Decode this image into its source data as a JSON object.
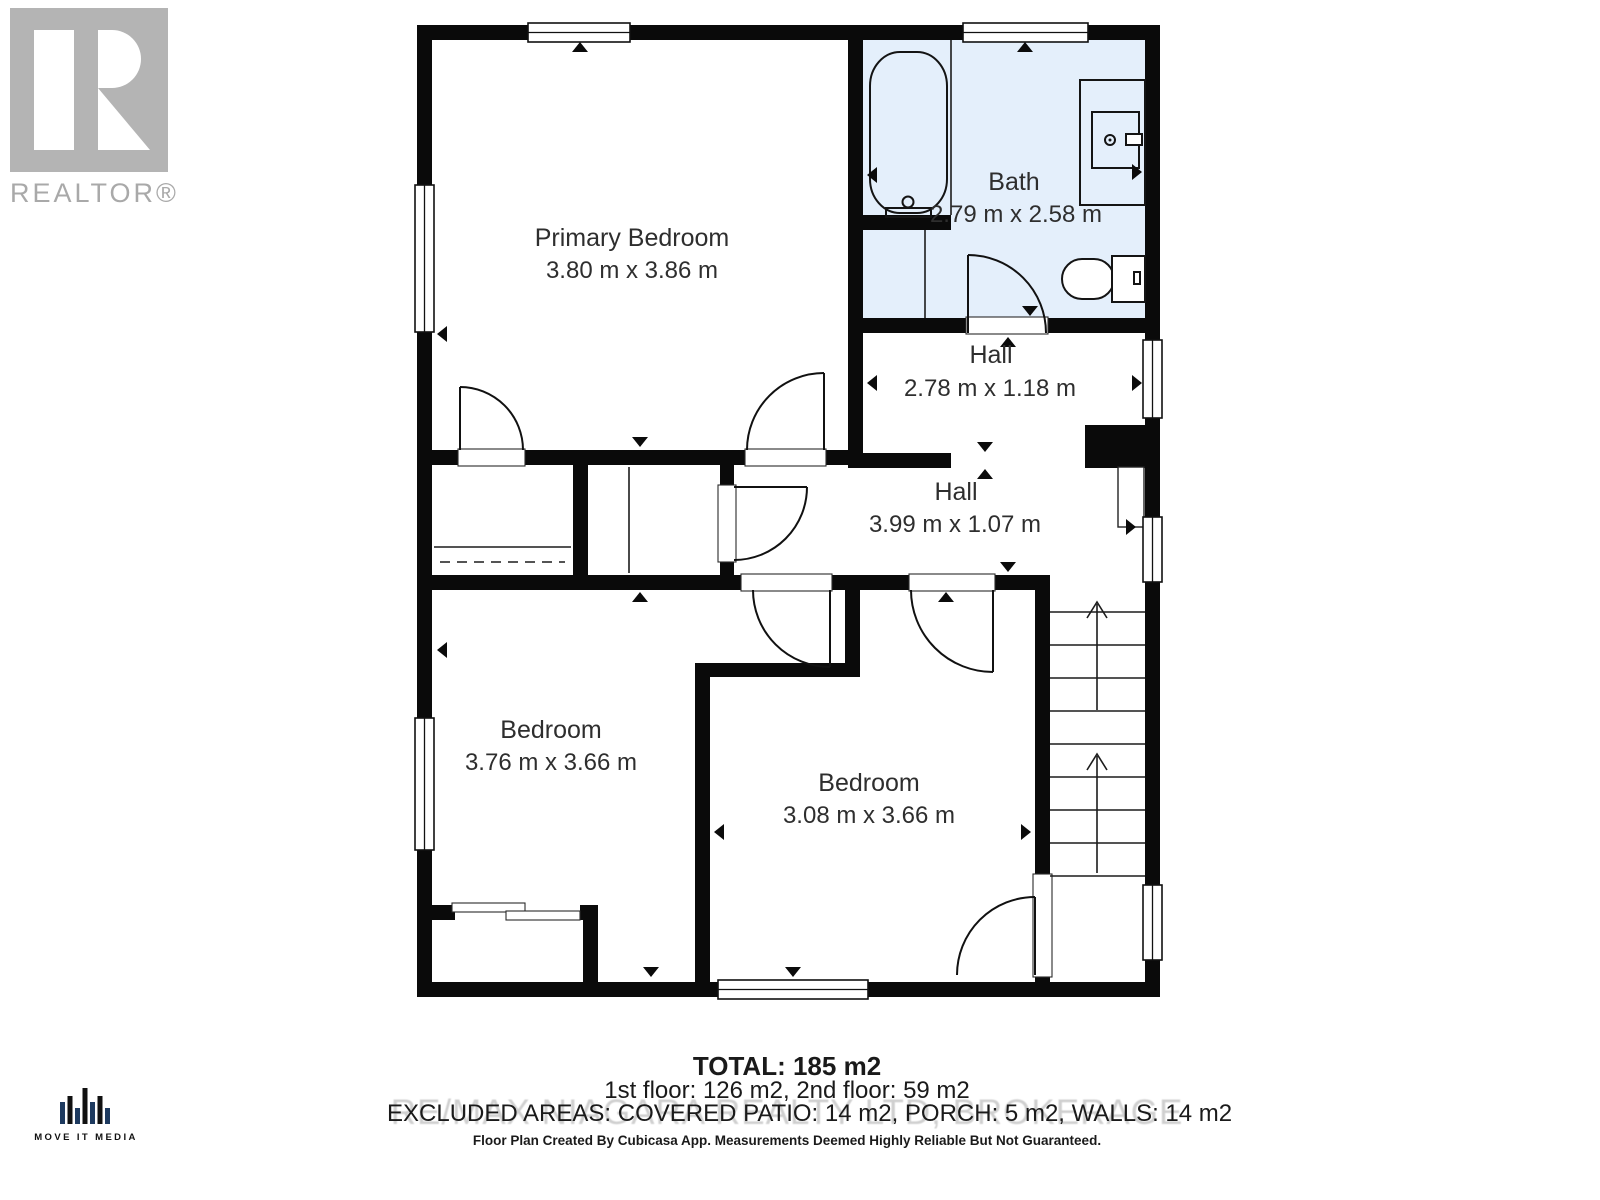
{
  "branding": {
    "realtor_logo_text": "REALTOR®",
    "media_logo_text": "MOVE IT MEDIA"
  },
  "rooms": [
    {
      "name": "Primary Bedroom",
      "dims": "3.80 m x 3.86 m"
    },
    {
      "name": "Bath",
      "dims": "2.79 m x 2.58 m"
    },
    {
      "name": "Hall",
      "dims": "2.78 m x 1.18 m"
    },
    {
      "name": "Hall",
      "dims": "3.99 m x 1.07 m"
    },
    {
      "name": "Bedroom",
      "dims": "3.76 m x 3.66 m"
    },
    {
      "name": "Bedroom",
      "dims": "3.08 m x 3.66 m"
    }
  ],
  "summary": {
    "total": "TOTAL: 185 m2",
    "floors": "1st floor: 126 m2, 2nd floor: 59 m2",
    "excluded": "EXCLUDED AREAS: COVERED PATIO: 14 m2, PORCH: 5 m2, WALLS: 14 m2",
    "watermark": "RE/MAX NIAGARA REALTY LTD, BROKERAGE",
    "disclaimer": "Floor Plan Created By Cubicasa App. Measurements Deemed Highly Reliable But Not Guaranteed."
  },
  "colors": {
    "wall": "#0a0a0a",
    "bath_fill": "#e4effb",
    "watermark": "#c4c4c4",
    "logo_gray": "#b4b4b4",
    "bar_navy": "#1e3a5f"
  }
}
